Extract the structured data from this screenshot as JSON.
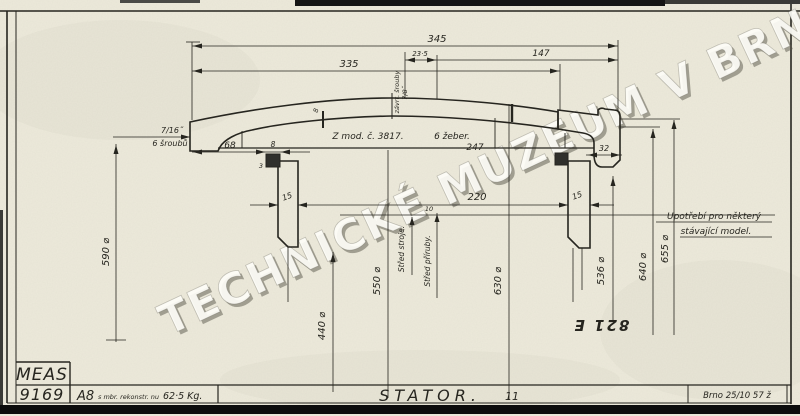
{
  "watermark": "TECHNICKÉ MUZEUM V BRNĚ",
  "stamp": "821 E",
  "drawing": {
    "dims": {
      "d345": "345",
      "d23_5": "23·5",
      "d147": "147",
      "d335": "335",
      "d68": "68",
      "d8": "8",
      "d3": "3",
      "d32": "32",
      "d15_left": "15",
      "d15_right": "15",
      "d220": "220",
      "d247": "247",
      "d8_plate": "8",
      "d10": "10",
      "dia590": "590 ⌀",
      "dia550": "550 ⌀",
      "dia440": "440 ⌀",
      "dia630": "630 ⌀",
      "dia536": "536 ⌀",
      "dia640": "640 ⌀",
      "dia655": "655 ⌀"
    },
    "labels": {
      "bolt_spec": "7/16˝",
      "bolt_count": "6 šroubů",
      "model_ref": "Z mod. č. 3817.",
      "ribs": "6 žeber.",
      "apex_note_1": "závrt. šrouby",
      "apex_note_2": "7/8˝",
      "center_machine": "Střed stroje.",
      "center_flange": "Střed příruby.",
      "note_line1": "Upotřebí pro některý",
      "note_line2": "stávající model."
    }
  },
  "title_block": {
    "org": "MEAS",
    "drawing_number": "9169",
    "pattern_code": "A8",
    "pattern_note": "s mbr. rekonstr. nu",
    "weight": "62·5 Kg.",
    "title": "STATOR.",
    "sheet_no": "11",
    "place_date": "Brno 25/10 57 ž"
  },
  "colors": {
    "paper": "#edeadb",
    "ink": "#26251f",
    "frame": "#0c0c0c"
  }
}
